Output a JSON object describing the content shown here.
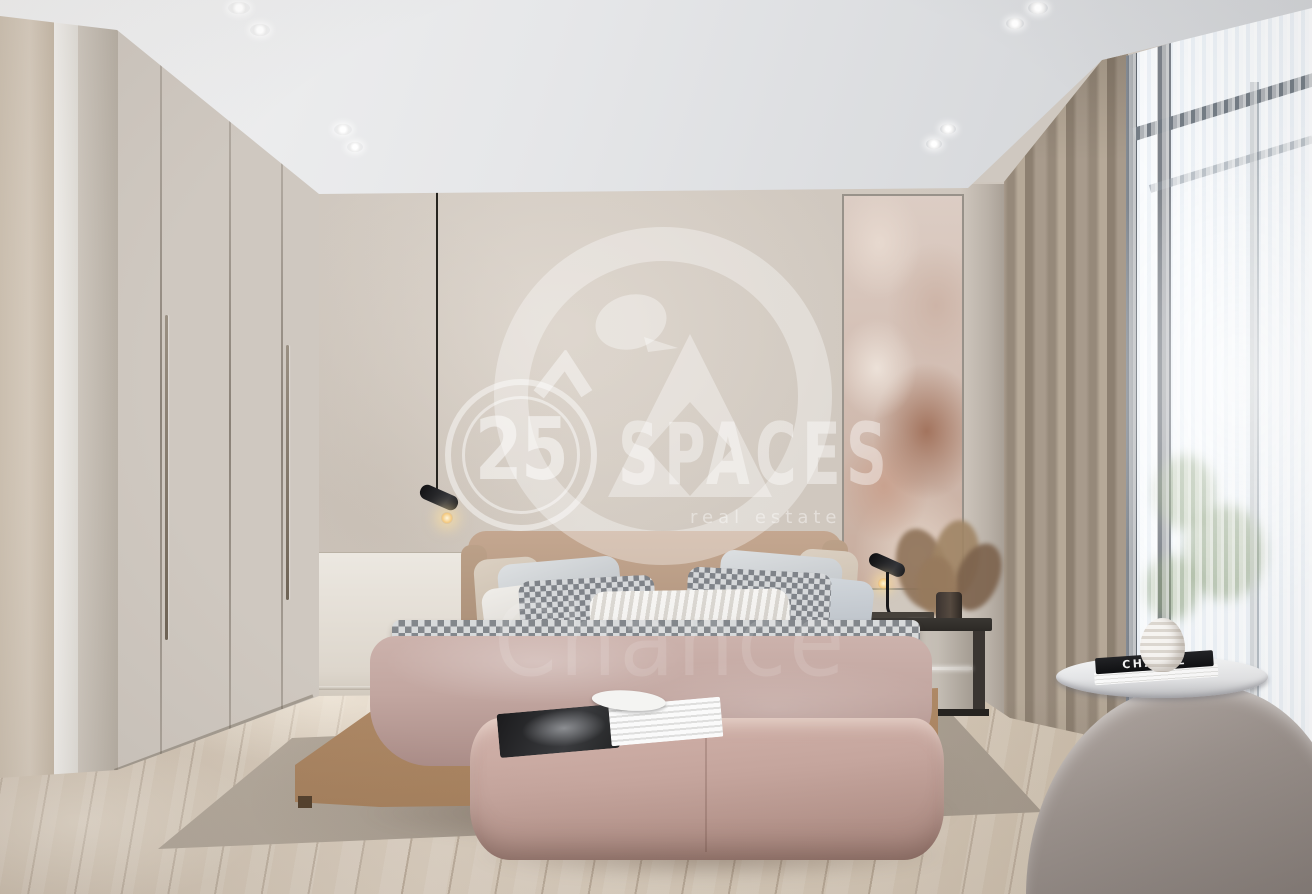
{
  "photo": {
    "description": "Modern neutral bedroom interior rendering with large watermark",
    "room": "bedroom"
  },
  "watermark": {
    "badge_number": "25",
    "brand_name": "SPACES",
    "tagline": "real estate",
    "overlay_text": "Chance"
  },
  "decor": {
    "coffee_table_book_title": "CHANEL"
  },
  "palette": {
    "ceiling": "#e9eaec",
    "wall_greige": "#cfc8c0",
    "wardrobe": "#c6beb3",
    "floor_wood": "#d2c3b1",
    "rug": "#ada295",
    "duvet_pink": "#c2a6a0",
    "bed_leather": "#c19c7a",
    "ottoman_blush": "#c5a59d",
    "curtain_taupe": "#a2957f",
    "sheer_white": "#eef3f8",
    "armchair_gray": "#9b928d",
    "art_rust": "#a3745e",
    "lamp_black": "#17171a",
    "watermark_white": "#ffffff"
  }
}
